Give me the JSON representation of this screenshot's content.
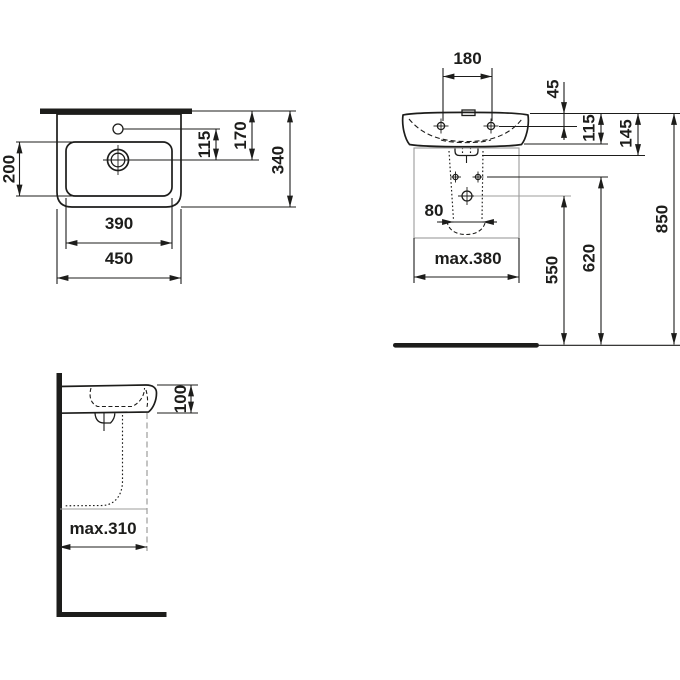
{
  "dims": {
    "top": {
      "d115": "115",
      "d170": "170",
      "d340": "340",
      "d200": "200",
      "d390": "390",
      "d450": "450"
    },
    "front": {
      "d180": "180",
      "d45": "45",
      "d115": "115",
      "d145": "145",
      "d80": "80",
      "dmax380": "max.380",
      "d550": "550",
      "d620": "620",
      "d850": "850"
    },
    "side": {
      "d100": "100",
      "dmax310": "max.310"
    }
  },
  "colors": {
    "ink": "#1d1d1b",
    "gray": "#9c9c9b",
    "background": "#ffffff"
  }
}
